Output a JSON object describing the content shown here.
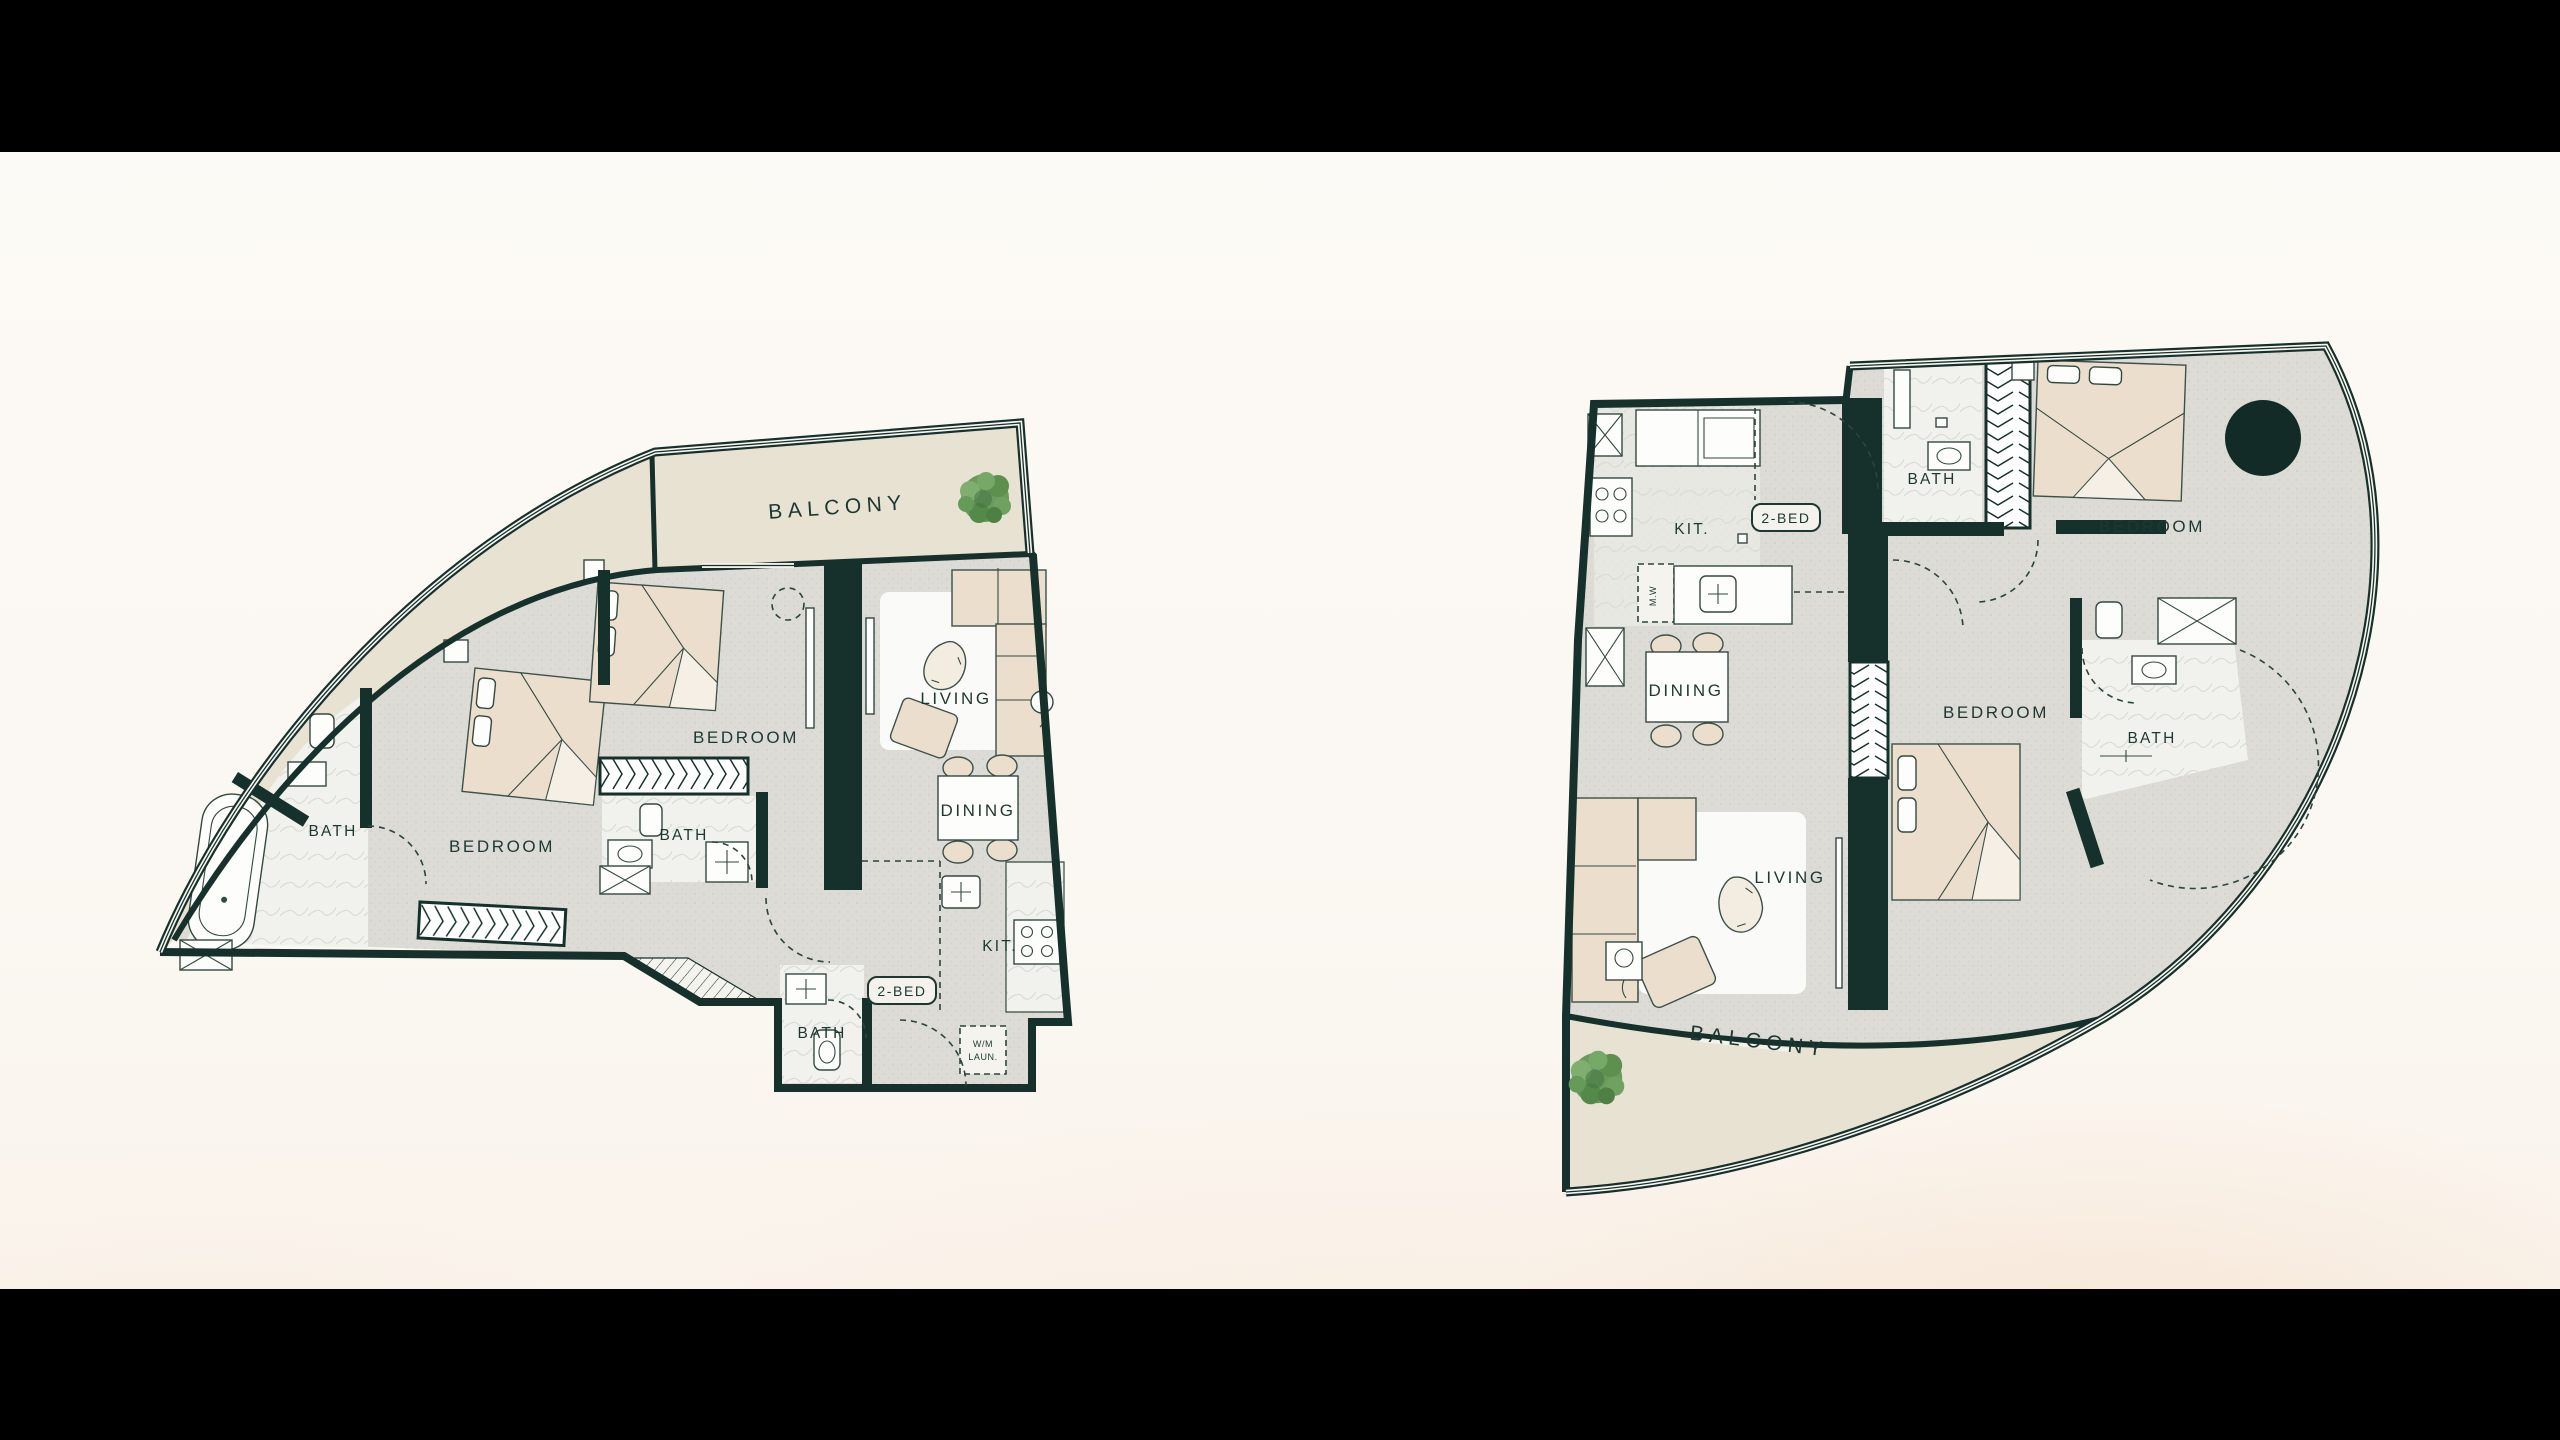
{
  "scene": {
    "description": "Two curved 2-bedroom apartment floor plans, letterboxed",
    "letterbox_color": "#000000",
    "background_color": "#fbf8f3"
  },
  "palette": {
    "wall": "#16302b",
    "floor": "#dcdbd5",
    "balcony": "#e7e2d2",
    "marble": "#f1f2ee",
    "furniture": "#ecdecd",
    "label": "#1d3832",
    "tree_green": "#649a56",
    "column_circle": "#132b26"
  },
  "plans": {
    "left": {
      "name": "2-bedroom-unit-left",
      "balcony": "BALCONY",
      "unit_badge": "2-BED",
      "rooms": {
        "bath_corner": "BATH",
        "bedroom_primary": "BEDROOM",
        "bath_middle": "BATH",
        "bedroom_second": "BEDROOM",
        "living": "LIVING",
        "dining": "DINING",
        "kitchen": "KIT.",
        "bath_entry": "BATH",
        "laundry_line1": "W/M",
        "laundry_line2": "LAUN."
      }
    },
    "right": {
      "name": "2-bedroom-unit-right",
      "balcony": "BALCONY",
      "unit_badge": "2-BED",
      "rooms": {
        "kitchen": "KIT.",
        "microwave": "M.W",
        "bath_top": "BATH",
        "bedroom_primary": "BEDROOM",
        "dining": "DINING",
        "bedroom_second": "BEDROOM",
        "bath_right": "BATH",
        "living": "LIVING"
      }
    }
  }
}
